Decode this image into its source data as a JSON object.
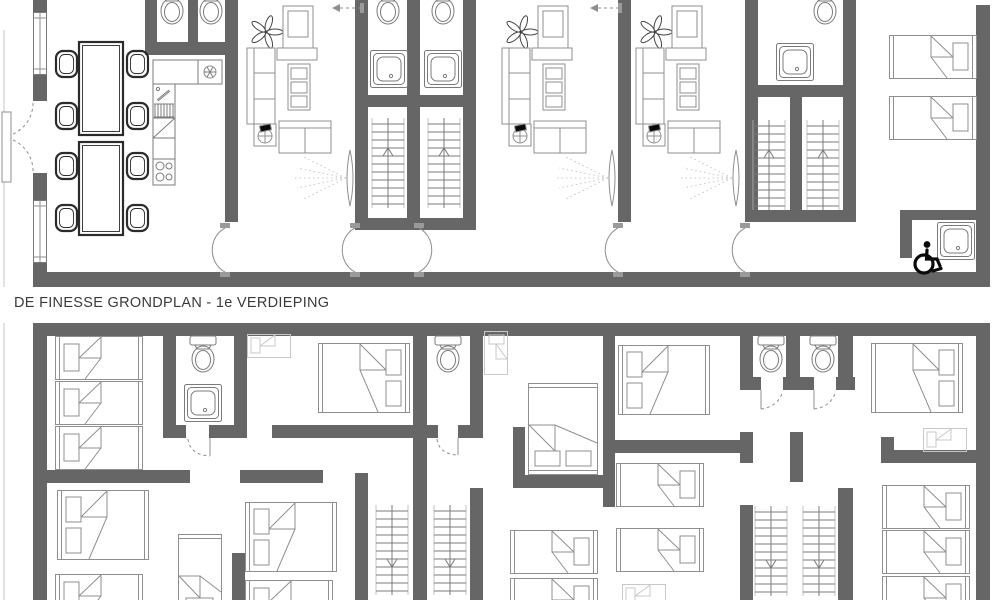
{
  "title": {
    "text": "DE FINESSE GRONDPLAN - 1e VERDIEPING"
  },
  "colors": {
    "background": "#ffffff",
    "wall": "#666666",
    "line": "#8f8f8f",
    "line_mid": "#7b7b7b",
    "line_dark": "#2b2b2b",
    "faint": "#c8c8c8",
    "black": "#0a0a0a",
    "title_text": "#3b3b3b"
  },
  "icons": {
    "toilet-icon": "oval bowl with cistern",
    "shower-icon": "nested rounded squares with drain dot",
    "stairs-up-icon": "treads with up chevron",
    "stairs-down-icon": "treads with down chevron",
    "ceiling-fan-icon": "five blade rosette",
    "portable-fan-icon": "fan on side table",
    "fridge-icon": "square with snowflake",
    "wheelchair-icon": "accessibility symbol",
    "door-swing-icon": "arc with leaf",
    "radiator-icon": "wall lens with dotted rays",
    "window-icon": "double-line frame in wall",
    "single-bed-icon": "rect with pillow and folded sheet",
    "double-bed-icon": "rect with two pillows and folded sheet",
    "dining-table-icon": "double rectangle",
    "chair-icon": "rounded square",
    "sofa-icon": "three cushion couch",
    "loveseat-icon": "two cushion couch",
    "tv-cabinet-icon": "dresser with tv",
    "shelf-icon": "cabinet with three boxes",
    "sink-icon": "basin with faucet",
    "stove-icon": "four burner cooktop",
    "counter-icon": "hatched worktop"
  }
}
